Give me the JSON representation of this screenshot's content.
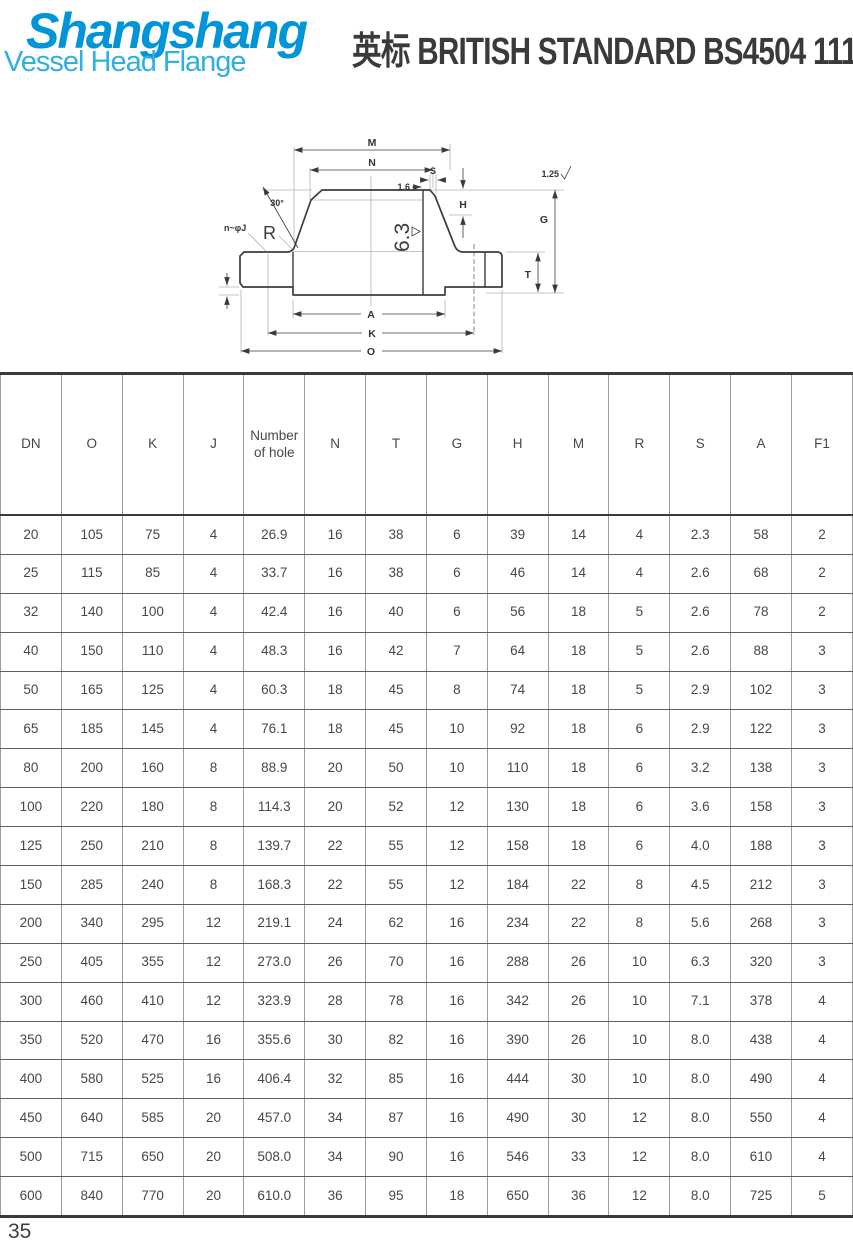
{
  "header": {
    "logo_title": "Shangshang",
    "logo_subtitle": "Vessel Head Flange",
    "title_cn": "英标",
    "title_en": "BRITISH STANDARD BS4504 111 R F PN 16",
    "logo_color": "#0094d9",
    "logo_subtitle_color": "#2fafe3",
    "title_color": "#3a3a3a"
  },
  "drawing": {
    "labels": {
      "m": "M",
      "n": "N",
      "s": "S",
      "s_gap": "1.6",
      "angle": "30°",
      "bolt_holes": "n~φJ",
      "radius": "R",
      "surface_side": "6.3",
      "surface_top": "1.25",
      "h": "H",
      "g": "G",
      "t": "T",
      "a": "A",
      "k": "K",
      "o": "O"
    }
  },
  "table": {
    "columns": [
      "DN",
      "O",
      "K",
      "J",
      "Number of hole",
      "N",
      "T",
      "G",
      "H",
      "M",
      "R",
      "S",
      "A",
      "F1"
    ],
    "rows": [
      [
        "20",
        "105",
        "75",
        "4",
        "26.9",
        "16",
        "38",
        "6",
        "39",
        "14",
        "4",
        "2.3",
        "58",
        "2"
      ],
      [
        "25",
        "115",
        "85",
        "4",
        "33.7",
        "16",
        "38",
        "6",
        "46",
        "14",
        "4",
        "2.6",
        "68",
        "2"
      ],
      [
        "32",
        "140",
        "100",
        "4",
        "42.4",
        "16",
        "40",
        "6",
        "56",
        "18",
        "5",
        "2.6",
        "78",
        "2"
      ],
      [
        "40",
        "150",
        "110",
        "4",
        "48.3",
        "16",
        "42",
        "7",
        "64",
        "18",
        "5",
        "2.6",
        "88",
        "3"
      ],
      [
        "50",
        "165",
        "125",
        "4",
        "60.3",
        "18",
        "45",
        "8",
        "74",
        "18",
        "5",
        "2.9",
        "102",
        "3"
      ],
      [
        "65",
        "185",
        "145",
        "4",
        "76.1",
        "18",
        "45",
        "10",
        "92",
        "18",
        "6",
        "2.9",
        "122",
        "3"
      ],
      [
        "80",
        "200",
        "160",
        "8",
        "88.9",
        "20",
        "50",
        "10",
        "110",
        "18",
        "6",
        "3.2",
        "138",
        "3"
      ],
      [
        "100",
        "220",
        "180",
        "8",
        "114.3",
        "20",
        "52",
        "12",
        "130",
        "18",
        "6",
        "3.6",
        "158",
        "3"
      ],
      [
        "125",
        "250",
        "210",
        "8",
        "139.7",
        "22",
        "55",
        "12",
        "158",
        "18",
        "6",
        "4.0",
        "188",
        "3"
      ],
      [
        "150",
        "285",
        "240",
        "8",
        "168.3",
        "22",
        "55",
        "12",
        "184",
        "22",
        "8",
        "4.5",
        "212",
        "3"
      ],
      [
        "200",
        "340",
        "295",
        "12",
        "219.1",
        "24",
        "62",
        "16",
        "234",
        "22",
        "8",
        "5.6",
        "268",
        "3"
      ],
      [
        "250",
        "405",
        "355",
        "12",
        "273.0",
        "26",
        "70",
        "16",
        "288",
        "26",
        "10",
        "6.3",
        "320",
        "3"
      ],
      [
        "300",
        "460",
        "410",
        "12",
        "323.9",
        "28",
        "78",
        "16",
        "342",
        "26",
        "10",
        "7.1",
        "378",
        "4"
      ],
      [
        "350",
        "520",
        "470",
        "16",
        "355.6",
        "30",
        "82",
        "16",
        "390",
        "26",
        "10",
        "8.0",
        "438",
        "4"
      ],
      [
        "400",
        "580",
        "525",
        "16",
        "406.4",
        "32",
        "85",
        "16",
        "444",
        "30",
        "10",
        "8.0",
        "490",
        "4"
      ],
      [
        "450",
        "640",
        "585",
        "20",
        "457.0",
        "34",
        "87",
        "16",
        "490",
        "30",
        "12",
        "8.0",
        "550",
        "4"
      ],
      [
        "500",
        "715",
        "650",
        "20",
        "508.0",
        "34",
        "90",
        "16",
        "546",
        "33",
        "12",
        "8.0",
        "610",
        "4"
      ],
      [
        "600",
        "840",
        "770",
        "20",
        "610.0",
        "36",
        "95",
        "18",
        "650",
        "36",
        "12",
        "8.0",
        "725",
        "5"
      ]
    ]
  },
  "page": {
    "number": "35"
  }
}
